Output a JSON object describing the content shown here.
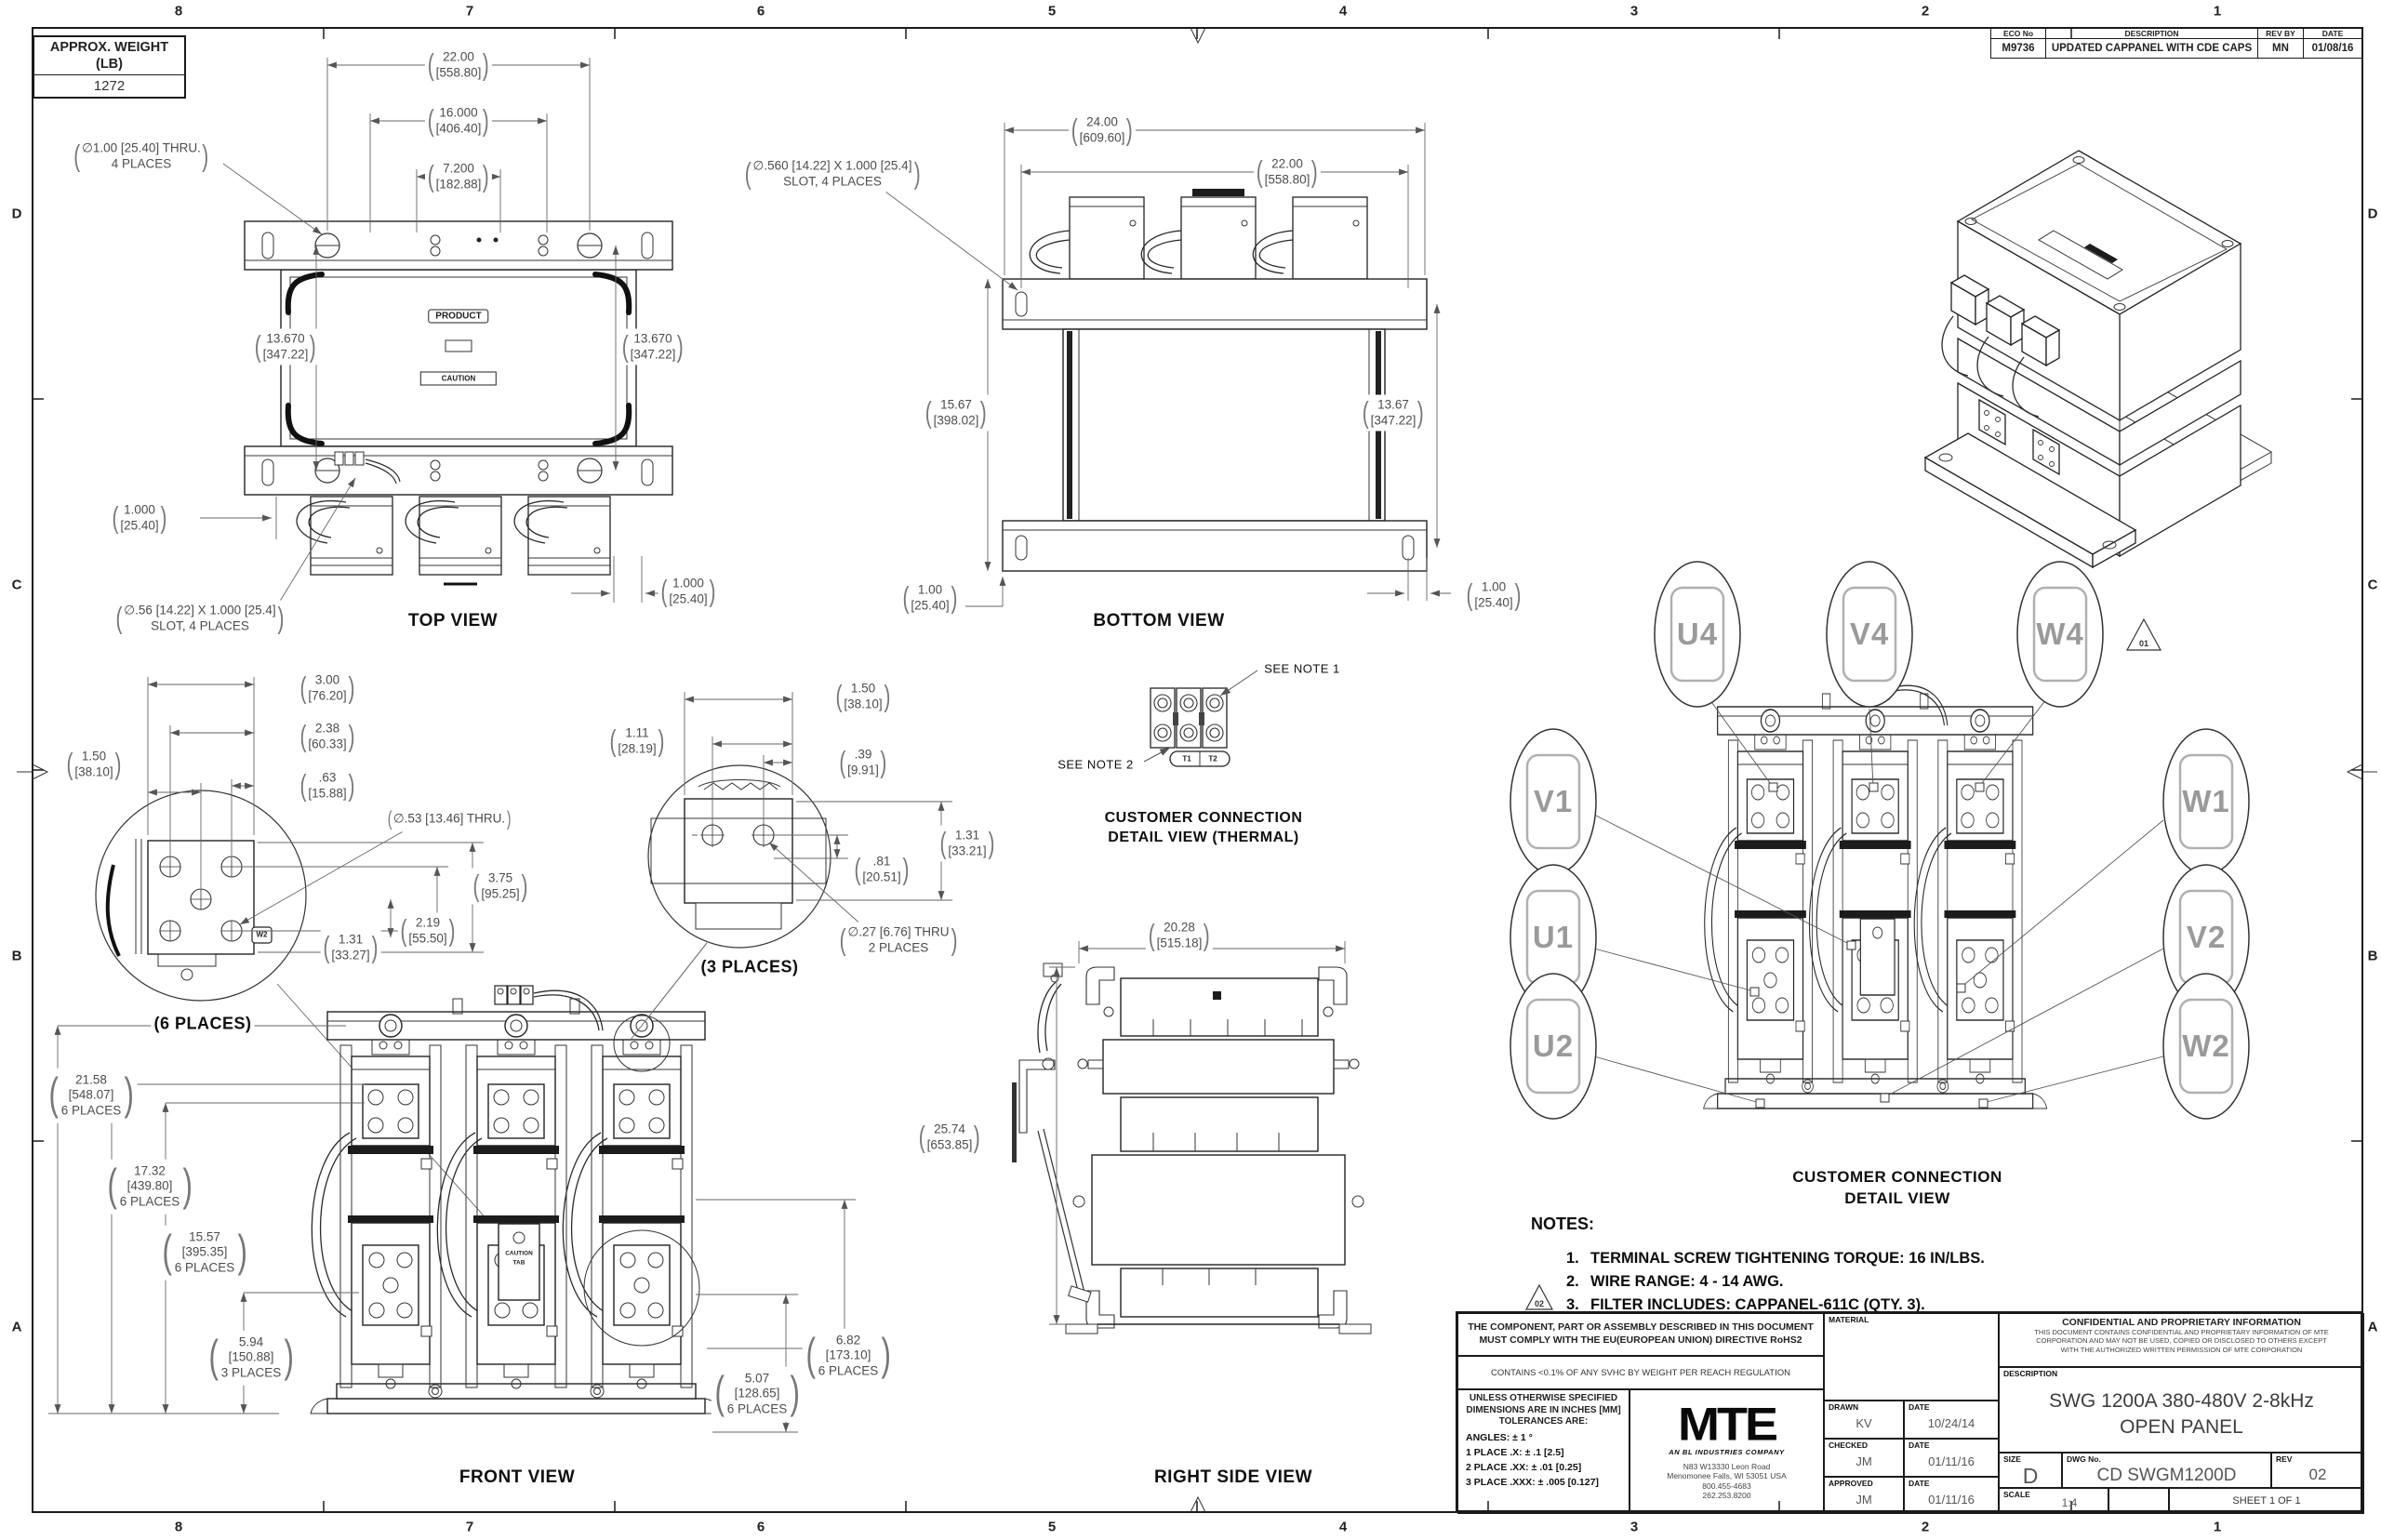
{
  "sheet": {
    "zones_top": [
      "8",
      "7",
      "6",
      "5",
      "4",
      "3",
      "2",
      "1"
    ],
    "zones_bottom": [
      "8",
      "7",
      "6",
      "5",
      "4",
      "3",
      "2",
      "1"
    ],
    "zones_left": [
      "D",
      "C",
      "B",
      "A"
    ],
    "zones_right": [
      "D",
      "C",
      "B",
      "A"
    ]
  },
  "weight_box": {
    "title1": "APPROX. WEIGHT",
    "title2": "(LB)",
    "value": "1272"
  },
  "eco": {
    "h_no": "ECO No",
    "h_desc": "DESCRIPTION",
    "h_rev": "REV BY",
    "h_date": "DATE",
    "no": "M9736",
    "desc": "UPDATED CAPPANEL WITH CDE CAPS",
    "rev": "MN",
    "date": "01/08/16"
  },
  "top": {
    "label": "TOP VIEW",
    "product": "PRODUCT",
    "caution": "CAUTION",
    "d22": {
      "in": "22.00",
      "mm": "[558.80]"
    },
    "d16": {
      "in": "16.000",
      "mm": "[406.40]"
    },
    "d72": {
      "in": "7.200",
      "mm": "[182.88]"
    },
    "d1367L": {
      "in": "13.670",
      "mm": "[347.22]"
    },
    "d1367R": {
      "in": "13.670",
      "mm": "[347.22]"
    },
    "d1L": {
      "in": "1.000",
      "mm": "[25.40]"
    },
    "d1R": {
      "in": "1.000",
      "mm": "[25.40]"
    },
    "hole_note": {
      "l1": "∅1.00 [25.40] THRU.",
      "l2": "4 PLACES"
    },
    "slot_note": {
      "l1": "∅.56 [14.22] X 1.000 [25.4]",
      "l2": "SLOT, 4 PLACES"
    }
  },
  "bottom": {
    "label": "BOTTOM VIEW",
    "d24": {
      "in": "24.00",
      "mm": "[609.60]"
    },
    "d22": {
      "in": "22.00",
      "mm": "[558.80]"
    },
    "d1567": {
      "in": "15.67",
      "mm": "[398.02]"
    },
    "d1367": {
      "in": "13.67",
      "mm": "[347.22]"
    },
    "d1L": {
      "in": "1.00",
      "mm": "[25.40]"
    },
    "d1R": {
      "in": "1.00",
      "mm": "[25.40]"
    },
    "slot_note": {
      "l1": "∅.560 [14.22] X 1.000 [25.4]",
      "l2": "SLOT, 4 PLACES"
    }
  },
  "detail6": {
    "label": "(6 PLACES)",
    "tag": "W2",
    "d300": {
      "in": "3.00",
      "mm": "[76.20]"
    },
    "d238": {
      "in": "2.38",
      "mm": "[60.33]"
    },
    "d63": {
      "in": ".63",
      "mm": "[15.88]"
    },
    "d150": {
      "in": "1.50",
      "mm": "[38.10]"
    },
    "hole": "∅.53 [13.46] THRU.",
    "d375": {
      "in": "3.75",
      "mm": "[95.25]"
    },
    "d219": {
      "in": "2.19",
      "mm": "[55.50]"
    },
    "d131": {
      "in": "1.31",
      "mm": "[33.27]"
    }
  },
  "detail3": {
    "label": "(3 PLACES)",
    "d150": {
      "in": "1.50",
      "mm": "[38.10]"
    },
    "d111": {
      "in": "1.11",
      "mm": "[28.19]"
    },
    "d39": {
      "in": ".39",
      "mm": "[9.91]"
    },
    "d81": {
      "in": ".81",
      "mm": "[20.51]"
    },
    "d131": {
      "in": "1.31",
      "mm": "[33.21]"
    },
    "hole": {
      "l1": "∅.27 [6.76] THRU",
      "l2": "2 PLACES"
    }
  },
  "thermal": {
    "note1": "SEE NOTE 1",
    "note2": "SEE NOTE 2",
    "t1": "T1",
    "t2": "T2",
    "title1": "CUSTOMER CONNECTION",
    "title2": "DETAIL VIEW (THERMAL)"
  },
  "front": {
    "label": "FRONT VIEW",
    "tag1": "CAUTION",
    "tag2": "TAB",
    "d2158": {
      "in": "21.58",
      "mm": "[548.07]",
      "note": "6 PLACES"
    },
    "d1732": {
      "in": "17.32",
      "mm": "[439.80]",
      "note": "6 PLACES"
    },
    "d1557": {
      "in": "15.57",
      "mm": "[395.35]",
      "note": "6 PLACES"
    },
    "d594": {
      "in": "5.94",
      "mm": "[150.88]",
      "note": "3 PLACES"
    },
    "d507": {
      "in": "5.07",
      "mm": "[128.65]",
      "note": "6 PLACES"
    },
    "d682": {
      "in": "6.82",
      "mm": "[173.10]",
      "note": "6 PLACES"
    }
  },
  "right": {
    "label": "RIGHT SIDE VIEW",
    "d2028": {
      "in": "20.28",
      "mm": "[515.18]"
    },
    "d2574": {
      "in": "25.74",
      "mm": "[653.85]"
    }
  },
  "conn": {
    "title1": "CUSTOMER CONNECTION",
    "title2": "DETAIL VIEW",
    "rev_flag": "01",
    "u4": "U4",
    "v4": "V4",
    "w4": "W4",
    "v1": "V1",
    "w1": "W1",
    "u1": "U1",
    "v2": "V2",
    "u2": "U2",
    "w2": "W2"
  },
  "notes": {
    "title": "NOTES:",
    "flag": "02",
    "items": [
      {
        "num": "1.",
        "text": "TERMINAL SCREW TIGHTENING TORQUE:  16 IN/LBS."
      },
      {
        "num": "2.",
        "text": "WIRE RANGE:  4 - 14 AWG."
      },
      {
        "num": "3.",
        "text": "FILTER INCLUDES: CAPPANEL-611C (QTY. 3)."
      }
    ]
  },
  "tb": {
    "compliance1": "THE COMPONENT, PART OR ASSEMBLY DESCRIBED IN THIS DOCUMENT",
    "compliance1b": "MUST COMPLY WITH THE EU(EUROPEAN UNION) DIRECTIVE RoHS2",
    "compliance2": "CONTAINS <0.1% OF ANY SVHC BY WEIGHT PER REACH REGULATION",
    "tol_title1": "UNLESS OTHERWISE SPECIFIED",
    "tol_title2": "DIMENSIONS ARE IN INCHES [MM]",
    "tol_title3": "TOLERANCES ARE:",
    "tol_angles": "ANGLES: ± 1 °",
    "tol1": "1 PLACE .X: ± .1 [2.5]",
    "tol2": "2 PLACE .XX: ± .01 [0.25]",
    "tol3": "3 PLACE .XXX: ± .005 [0.127]",
    "logo": "MTE",
    "tagline": "AN BL INDUSTRIES COMPANY",
    "addr1": "N83 W13330 Leon Road",
    "addr2": "Menomonee Falls, WI 53051 USA",
    "addr3": "800.455-4683",
    "addr4": "262.253.8200",
    "material": "MATERIAL",
    "drawn_l": "DRAWN",
    "drawn": "KV",
    "date_l": "DATE",
    "drawn_date": "10/24/14",
    "checked_l": "CHECKED",
    "checked": "JM",
    "checked_date": "01/11/16",
    "approved_l": "APPROVED",
    "approved": "JM",
    "approved_date": "01/11/16",
    "conf_title": "CONFIDENTIAL AND PROPRIETARY INFORMATION",
    "conf1": "THIS DOCUMENT CONTAINS CONFIDENTIAL AND PROPRIETARY INFORMATION OF MTE",
    "conf2": "CORPORATION AND MAY NOT BE USED, COPIED OR DISCLOSED TO OTHERS EXCEPT",
    "conf3": "WITH THE AUTHORIZED WRITTEN PERMISSION OF MTE CORPORATION",
    "desc_l": "DESCRIPTION",
    "desc1": "SWG 1200A 380-480V 2-8kHz",
    "desc2": "OPEN PANEL",
    "size_l": "SIZE",
    "size": "D",
    "dwg_l": "DWG No.",
    "dwg": "CD SWGM1200D",
    "rev_l": "REV",
    "rev": "02",
    "scale_l": "SCALE",
    "scale": "1:4",
    "sheet": "SHEET 1  OF 1"
  }
}
